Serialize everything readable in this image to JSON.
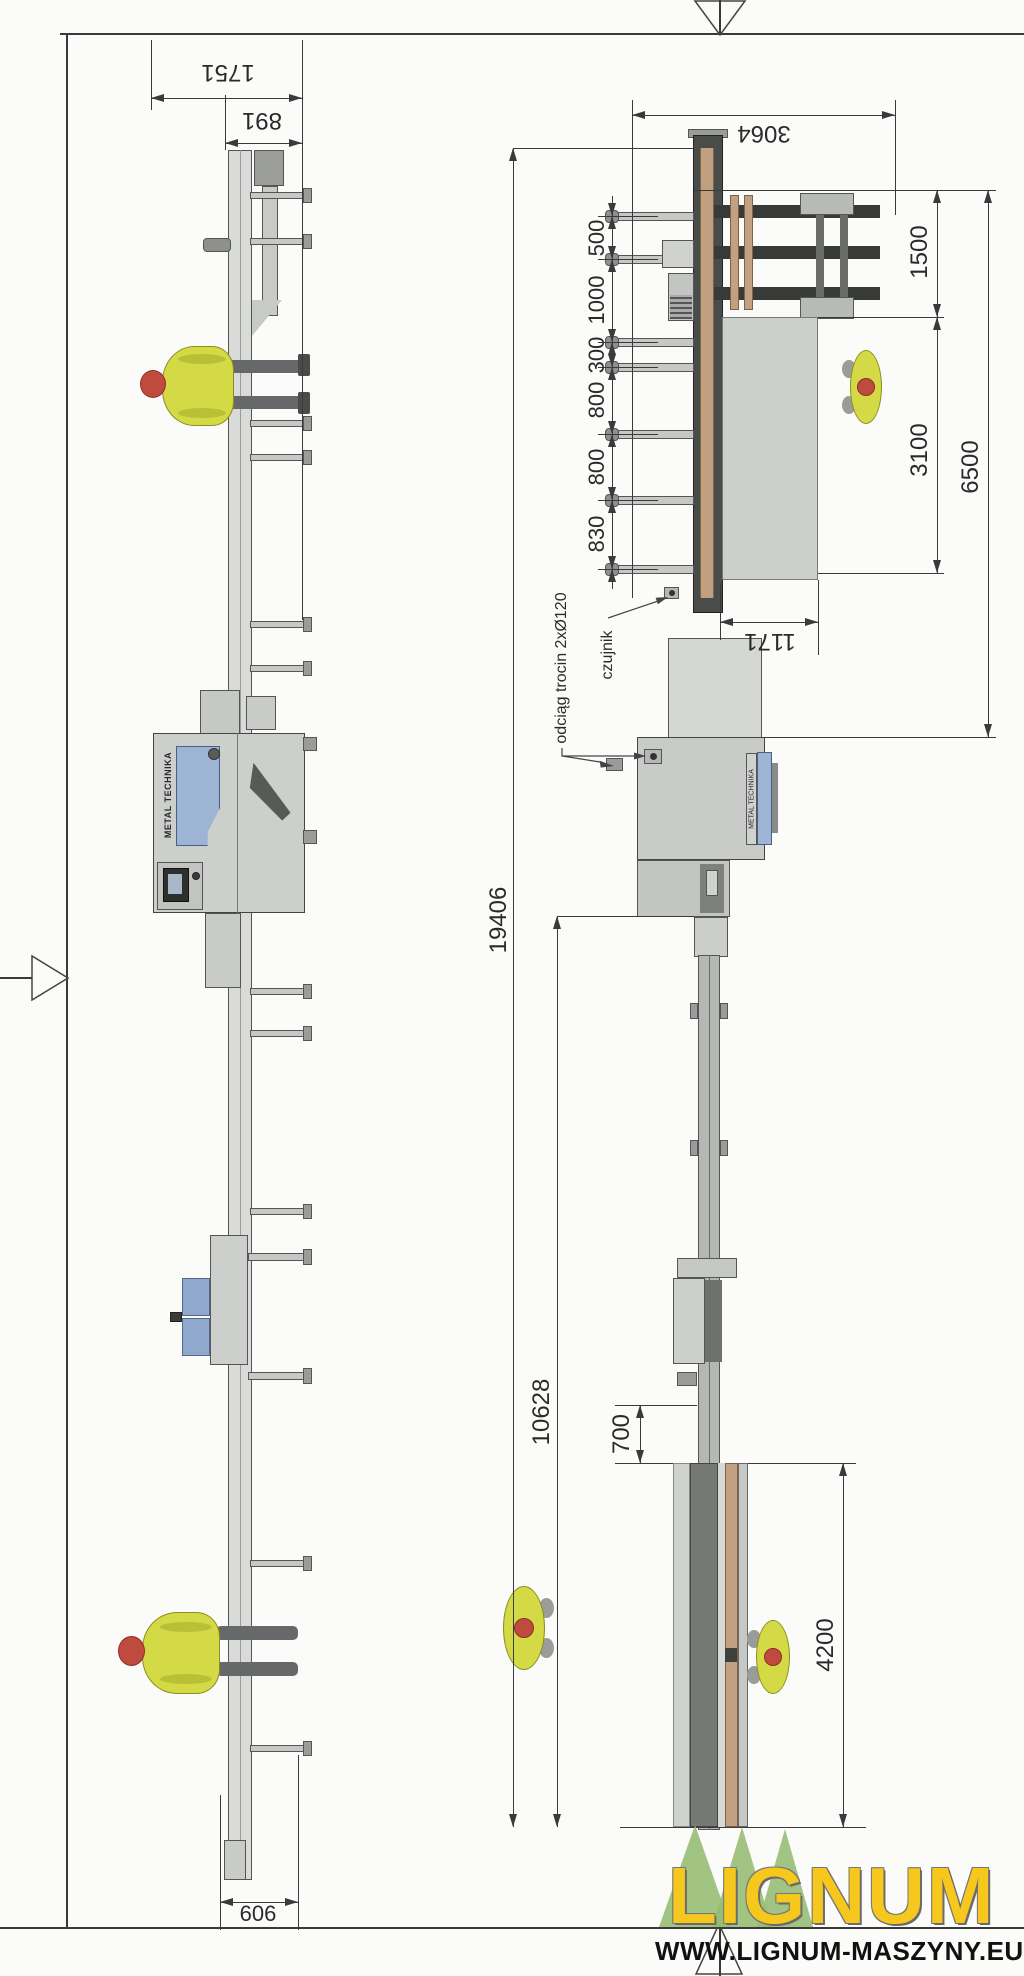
{
  "drawing": {
    "labels": {
      "dust_extraction": "odciąg trocin 2xØ120",
      "sensor": "czujnik",
      "machine_brand": "METAL TECHNIKA"
    },
    "dimensions": {
      "overall_length": "19406",
      "outfeed_length": "10628",
      "infeed_width": "3064",
      "cabinet_width": "1751",
      "cabinet_inner_width": "891",
      "base_width": "606",
      "chain_1": "500",
      "chain_2": "1000",
      "chain_3": "300",
      "chain_4": "800",
      "chain_5": "800",
      "chain_6": "830",
      "stack_zone": "1500",
      "table_zone": "3100",
      "infeed_zone": "6500",
      "table_width": "1171",
      "gap": "700",
      "outfeed_table": "4200"
    },
    "watermark": {
      "logo": "LIGNUM",
      "website": "WWW.LIGNUM-MASZYNY.EU"
    }
  }
}
